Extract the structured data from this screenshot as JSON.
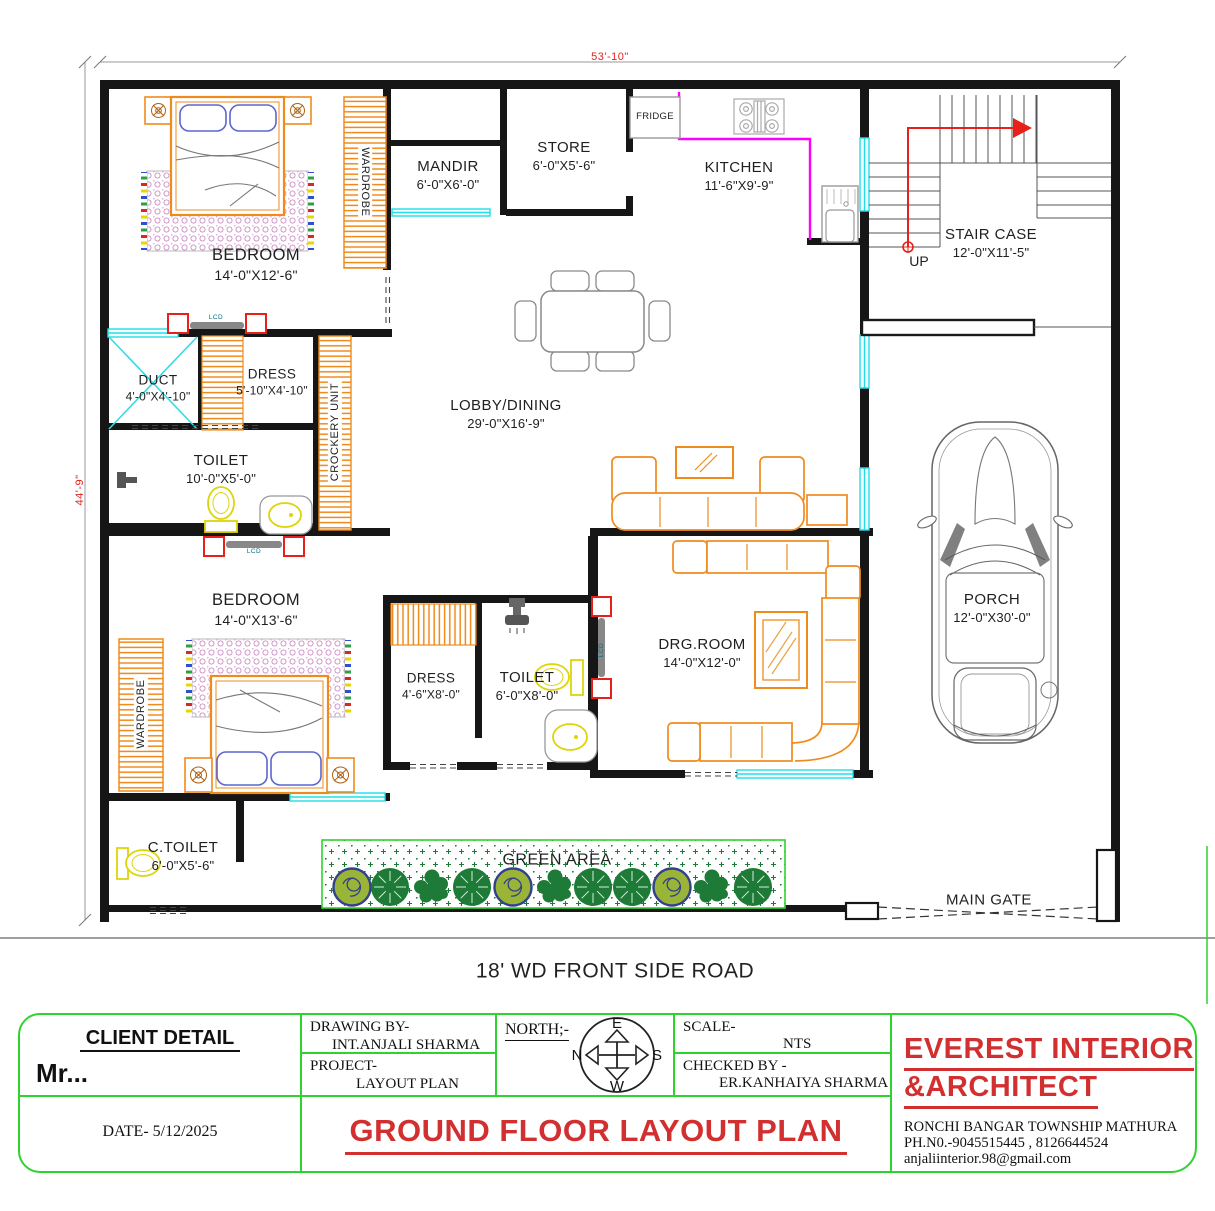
{
  "sheet": {
    "dim_top": "53'-10\"",
    "dim_left": "44'-9\"",
    "road_label": "18' WD FRONT SIDE ROAD"
  },
  "rooms": {
    "bedroom1": {
      "name": "BEDROOM",
      "size": "14'-0\"X12'-6\""
    },
    "mandir": {
      "name": "MANDIR",
      "size": "6'-0\"X6'-0\""
    },
    "store": {
      "name": "STORE",
      "size": "6'-0\"X5'-6\""
    },
    "kitchen": {
      "name": "KITCHEN",
      "size": "11'-6\"X9'-9\""
    },
    "staircase": {
      "name": "STAIR CASE",
      "size": "12'-0\"X11'-5\""
    },
    "duct": {
      "name": "DUCT",
      "size": "4'-0\"X4'-10\""
    },
    "dress1": {
      "name": "DRESS",
      "size": "5'-10\"X4'-10\""
    },
    "toilet1": {
      "name": "TOILET",
      "size": "10'-0\"X5'-0\""
    },
    "lobby": {
      "name": "LOBBY/DINING",
      "size": "29'-0\"X16'-9\""
    },
    "bedroom2": {
      "name": "BEDROOM",
      "size": "14'-0\"X13'-6\""
    },
    "dress2": {
      "name": "DRESS",
      "size": "4'-6\"X8'-0\""
    },
    "toilet2": {
      "name": "TOILET",
      "size": "6'-0\"X8'-0\""
    },
    "drgroom": {
      "name": "DRG.ROOM",
      "size": "14'-0\"X12'-0\""
    },
    "porch": {
      "name": "PORCH",
      "size": "12'-0\"X30'-0\""
    },
    "ctoilet": {
      "name": "C.TOILET",
      "size": "6'-0\"X5'-6\""
    }
  },
  "fixtures": {
    "wardrobe_top": "WARDROBE",
    "wardrobe_bottom": "WARDROBE",
    "crockery_unit": "CROCKERY UNIT",
    "fridge": "FRIDGE",
    "lcd_bedroom1": "LCD",
    "lcd_bedroom2": "LCD",
    "lcd_drg": "LCD",
    "up": "UP",
    "green_area": "GREEN AREA",
    "main_gate": "MAIN GATE"
  },
  "title_block": {
    "client_heading": "CLIENT DETAIL",
    "client_name": "Mr...",
    "date": "DATE- 5/12/2025",
    "drawing_by_label": "DRAWING BY-",
    "drawing_by_value": "INT.ANJALI SHARMA",
    "project_label": "PROJECT-",
    "project_value": "LAYOUT PLAN",
    "north_label": "NORTH;-",
    "compass_e": "E",
    "compass_n": "N",
    "compass_s": "S",
    "compass_w": "W",
    "scale_label": "SCALE-",
    "scale_value": "NTS",
    "checked_by_label": "CHECKED BY -",
    "checked_by_value": "ER.KANHAIYA SHARMA",
    "sheet_title": "GROUND FLOOR LAYOUT PLAN",
    "firm_line1": "EVEREST INTERIOR",
    "firm_line2": "&ARCHITECT",
    "firm_address": "RONCHI BANGAR TOWNSHIP MATHURA",
    "firm_phone": "PH.N0.-9045515445 , 8126644524",
    "firm_email": "anjaliinterior.98@gmail.com"
  },
  "colors": {
    "wall": "#161616",
    "furniture_orange": "#ef8b1d",
    "window_cyan": "#22dde6",
    "counter_magenta": "#ff00ff",
    "accent_red": "#e8201a",
    "title_red": "#d23030",
    "border_green": "#2fd32f",
    "tree_green": "#1e7a37",
    "sanitary_yellow": "#ded40a",
    "rug_pink": "#c77fc0",
    "pillow_blue": "#5d66cf"
  }
}
